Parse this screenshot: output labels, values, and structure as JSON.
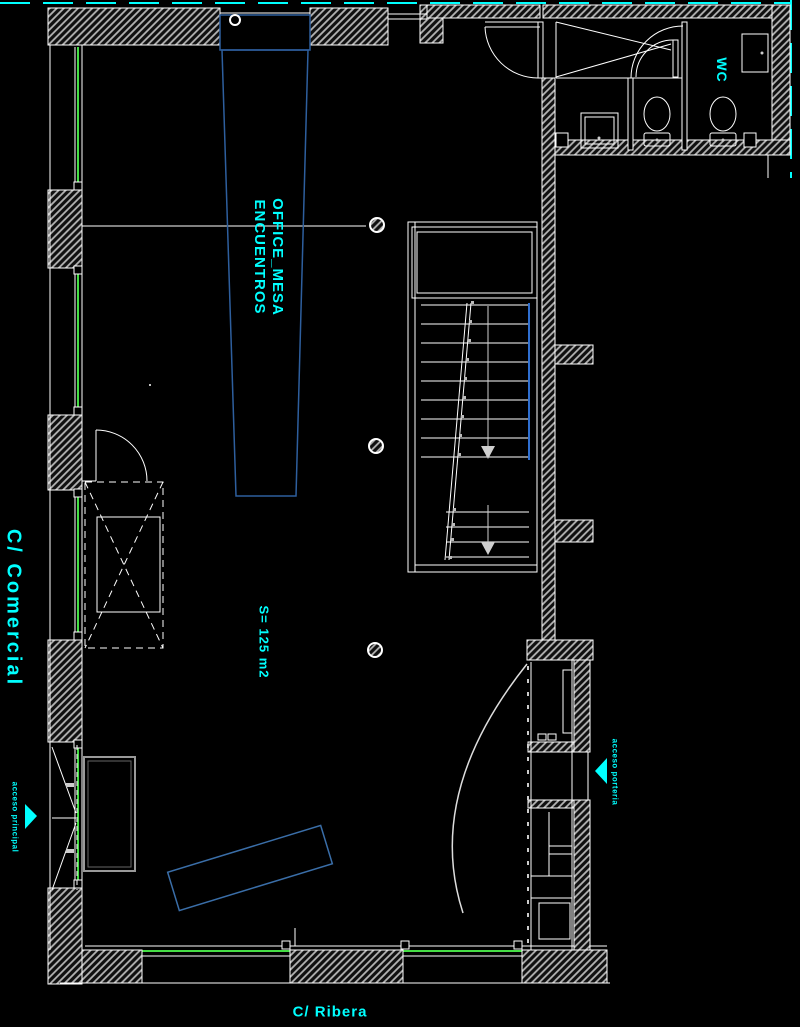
{
  "plan": {
    "streets": {
      "left": "C/ Comercial",
      "bottom": "C/ Ribera"
    },
    "rooms": {
      "wc": "WC"
    },
    "furniture": {
      "table_line1": "OFFICE_MESA",
      "table_line2": "ENCUENTROS"
    },
    "area_label": "S= 125 m2",
    "access": {
      "principal": "acceso principal",
      "porter": "acceso porteria"
    },
    "stairs": {
      "upper_steps": 9,
      "lower_steps": 4,
      "direction": "down",
      "flights": 2
    },
    "colors": {
      "background": "#000000",
      "walls": "#ffffff",
      "hatch": "#b5b5b5",
      "labels": "#00ffff",
      "glass": "#45dd45",
      "furniture_blue": "#2e5f9e",
      "stair_rail_blue": "#2f6fd0"
    }
  }
}
